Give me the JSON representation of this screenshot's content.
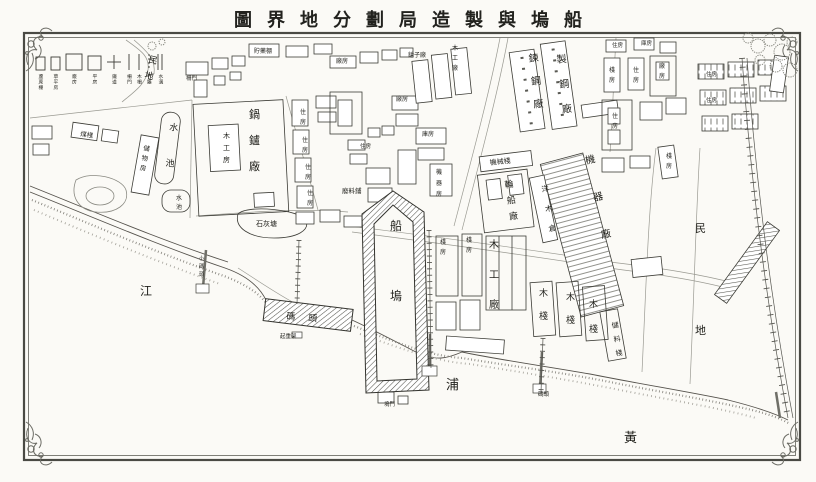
{
  "title": {
    "text": "船塢與製造局劃分地界圖",
    "display": "圖界地分劃局造製與塢船"
  },
  "river_name": "黃浦江",
  "legend": {
    "items": [
      {
        "symbol": "square-small",
        "label": "蘆蓆棚"
      },
      {
        "symbol": "square-small",
        "label": "草平房"
      },
      {
        "symbol": "square-large",
        "label": "廠房"
      },
      {
        "symbol": "square-medium",
        "label": "平房"
      },
      {
        "symbol": "cross",
        "label": "鐵道"
      },
      {
        "symbol": "line-solid",
        "label": "柵門"
      },
      {
        "symbol": "line-solid",
        "label": "木柵"
      },
      {
        "symbol": "line-dashed",
        "label": "竹籬"
      },
      {
        "symbol": "line-double",
        "label": "水溝"
      }
    ]
  },
  "colors": {
    "paper": "#fbfaf6",
    "ink": "#2e2e29",
    "frame": "#4a4a44",
    "light_line": "#9a9a92",
    "hatch": "#55554f"
  },
  "map": {
    "labels": [
      {
        "t": "民地",
        "x": 148,
        "y": 62,
        "v": 1,
        "cs": 16,
        "s": 9,
        "rot": 14
      },
      {
        "t": "水池",
        "x": 169,
        "y": 130,
        "v": 1,
        "cs": 36,
        "s": 9,
        "rot": 6
      },
      {
        "t": "鍋鑪廠",
        "x": 249,
        "y": 118,
        "v": 1,
        "cs": 26,
        "s": 11
      },
      {
        "t": "木工房",
        "x": 223,
        "y": 138,
        "v": 1,
        "cs": 12,
        "s": 7
      },
      {
        "t": "儲物房",
        "x": 143,
        "y": 150,
        "v": 1,
        "cs": 10,
        "s": 6.5,
        "rot": 10
      },
      {
        "t": "煤棧",
        "x": 80,
        "y": 136,
        "s": 6.5,
        "rot": 8
      },
      {
        "t": "水池",
        "x": 176,
        "y": 200,
        "v": 1,
        "cs": 9,
        "s": 6
      },
      {
        "t": "石灰塘",
        "x": 256,
        "y": 226,
        "s": 7
      },
      {
        "t": "廢料鋪",
        "x": 342,
        "y": 193,
        "s": 6.5
      },
      {
        "t": "貯藥棚",
        "x": 254,
        "y": 53,
        "s": 6
      },
      {
        "t": "柵門",
        "x": 186,
        "y": 80,
        "s": 5.5
      },
      {
        "t": "住房",
        "x": 300,
        "y": 114,
        "v": 1,
        "cs": 10,
        "s": 6
      },
      {
        "t": "住房",
        "x": 302,
        "y": 142,
        "v": 1,
        "cs": 10,
        "s": 6
      },
      {
        "t": "住房",
        "x": 305,
        "y": 169,
        "v": 1,
        "cs": 10,
        "s": 6
      },
      {
        "t": "住房",
        "x": 307,
        "y": 195,
        "v": 1,
        "cs": 10,
        "s": 6
      },
      {
        "t": "廠房",
        "x": 336,
        "y": 63,
        "s": 6
      },
      {
        "t": "鎗子廠",
        "x": 408,
        "y": 57,
        "s": 6
      },
      {
        "t": "木工廠",
        "x": 452,
        "y": 50,
        "v": 1,
        "cs": 10,
        "s": 6
      },
      {
        "t": "廠房",
        "x": 396,
        "y": 101,
        "s": 6
      },
      {
        "t": "庫房",
        "x": 422,
        "y": 136,
        "s": 6
      },
      {
        "t": "機器房",
        "x": 436,
        "y": 174,
        "v": 1,
        "cs": 11,
        "s": 6
      },
      {
        "t": "住房",
        "x": 360,
        "y": 148,
        "s": 5.5
      },
      {
        "t": "鍊鋼廠",
        "x": 529,
        "y": 62,
        "v": 1,
        "cs": 23,
        "s": 10,
        "rot": -6
      },
      {
        "t": "製鋼廠",
        "x": 557,
        "y": 63,
        "v": 1,
        "cs": 25,
        "s": 10,
        "rot": -6
      },
      {
        "t": "機械棧",
        "x": 490,
        "y": 165,
        "s": 7,
        "rot": -6
      },
      {
        "t": "輪船廠",
        "x": 505,
        "y": 188,
        "v": 1,
        "cs": 16,
        "s": 9,
        "rot": -8
      },
      {
        "t": "洋木倉",
        "x": 542,
        "y": 192,
        "v": 1,
        "cs": 20,
        "s": 7.5,
        "rot": -10
      },
      {
        "t": "機器廠",
        "x": 586,
        "y": 164,
        "v": 1,
        "cs": 38,
        "s": 10,
        "rot": -12
      },
      {
        "t": "船塢",
        "x": 390,
        "y": 230,
        "v": 1,
        "cs": 70,
        "s": 12
      },
      {
        "t": "碼頭",
        "x": 286,
        "y": 319,
        "s": 9,
        "ls": 13,
        "rot": 5
      },
      {
        "t": "起重架",
        "x": 280,
        "y": 338,
        "s": 5.5
      },
      {
        "t": "棧房",
        "x": 440,
        "y": 244,
        "v": 1,
        "cs": 10,
        "s": 6
      },
      {
        "t": "棧房",
        "x": 466,
        "y": 242,
        "v": 1,
        "cs": 10,
        "s": 6
      },
      {
        "t": "木工廠",
        "x": 489,
        "y": 248,
        "v": 1,
        "cs": 30,
        "s": 10
      },
      {
        "t": "木棧",
        "x": 539,
        "y": 296,
        "v": 1,
        "cs": 23,
        "s": 9
      },
      {
        "t": "木棧",
        "x": 566,
        "y": 300,
        "v": 1,
        "cs": 23,
        "s": 9
      },
      {
        "t": "木棧",
        "x": 589,
        "y": 307,
        "v": 1,
        "cs": 25,
        "s": 9
      },
      {
        "t": "儲料棧",
        "x": 612,
        "y": 328,
        "v": 1,
        "cs": 14,
        "s": 7,
        "rot": -8
      },
      {
        "t": "小碼頭",
        "x": 199,
        "y": 260,
        "v": 1,
        "cs": 8,
        "s": 5
      },
      {
        "t": "塢門",
        "x": 384,
        "y": 406,
        "s": 5.5
      },
      {
        "t": "碼頭",
        "x": 538,
        "y": 396,
        "s": 5.5
      },
      {
        "t": "住房",
        "x": 612,
        "y": 47,
        "s": 5.5
      },
      {
        "t": "庫房",
        "x": 641,
        "y": 45,
        "s": 5.5
      },
      {
        "t": "棧房",
        "x": 609,
        "y": 72,
        "v": 1,
        "cs": 10,
        "s": 6
      },
      {
        "t": "住房",
        "x": 633,
        "y": 72,
        "v": 1,
        "cs": 10,
        "s": 6
      },
      {
        "t": "廠房",
        "x": 659,
        "y": 68,
        "v": 1,
        "cs": 10,
        "s": 6
      },
      {
        "t": "住房",
        "x": 612,
        "y": 118,
        "v": 1,
        "cs": 10,
        "s": 6
      },
      {
        "t": "棧房",
        "x": 666,
        "y": 158,
        "v": 1,
        "cs": 10,
        "s": 6
      },
      {
        "t": "住房",
        "x": 706,
        "y": 76,
        "s": 5.5
      },
      {
        "t": "住房",
        "x": 706,
        "y": 102,
        "s": 5.5
      },
      {
        "t": "民地",
        "x": 695,
        "y": 232,
        "v": 1,
        "cs": 102,
        "s": 11
      },
      {
        "t": "江",
        "x": 140,
        "y": 295,
        "s": 12
      },
      {
        "t": "浦",
        "x": 446,
        "y": 389,
        "s": 13
      },
      {
        "t": "黃",
        "x": 624,
        "y": 442,
        "s": 13
      }
    ]
  }
}
